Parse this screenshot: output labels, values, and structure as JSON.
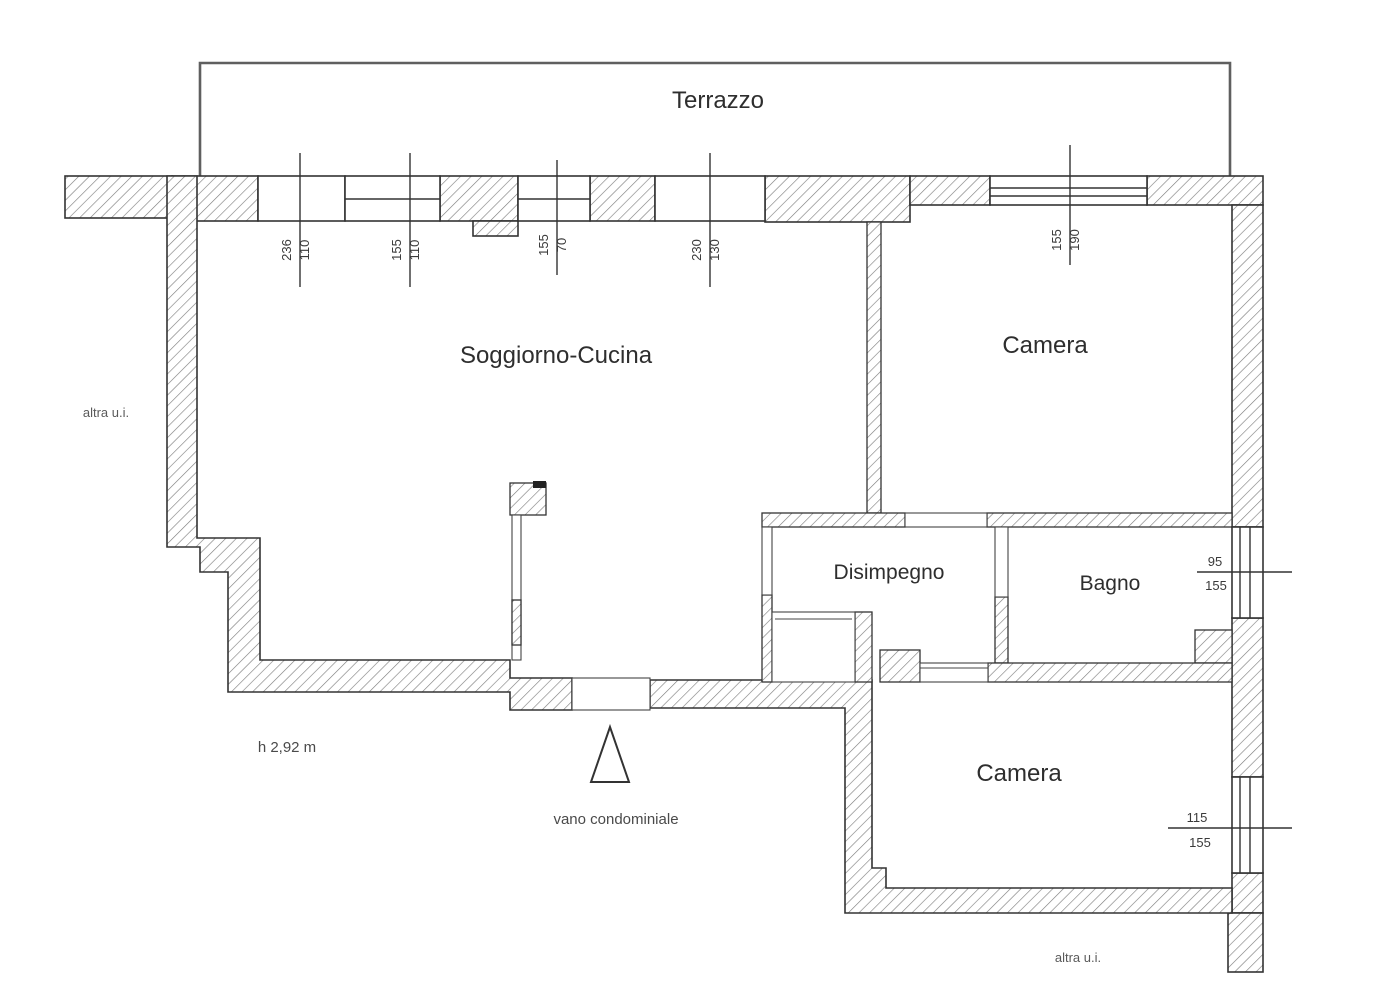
{
  "floorplan": {
    "terrace_label": "Terrazzo",
    "rooms": {
      "soggiorno": {
        "label": "Soggiorno-Cucina"
      },
      "camera_nord": {
        "label": "Camera"
      },
      "disimpegno": {
        "label": "Disimpegno"
      },
      "bagno": {
        "label": "Bagno"
      },
      "camera_sud": {
        "label": "Camera"
      }
    },
    "annotations": {
      "altra_ui_left": "altra u.i.",
      "altra_ui_bottom": "altra u.i.",
      "height_note": "h 2,92 m",
      "vano_label": "vano condominiale"
    },
    "dimensions": {
      "opening_1": {
        "num": "110",
        "den": "236"
      },
      "opening_2": {
        "num": "110",
        "den": "155"
      },
      "opening_3": {
        "num": "70",
        "den": "155"
      },
      "opening_4": {
        "num": "130",
        "den": "230"
      },
      "camera_nord_window": {
        "num": "190",
        "den": "155"
      },
      "bagno_window": {
        "num": "95",
        "den": "155"
      },
      "camera_sud_window": {
        "num": "115",
        "den": "155"
      }
    }
  }
}
